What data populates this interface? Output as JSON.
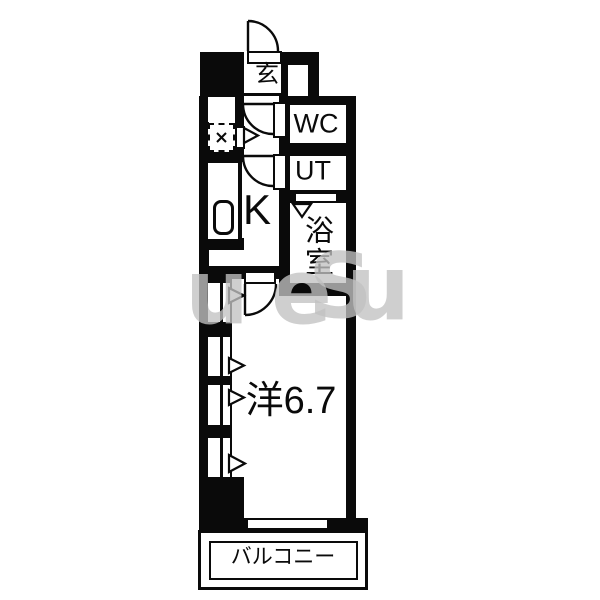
{
  "plan": {
    "type": "apartment-floor-plan",
    "rooms": {
      "genkan": {
        "label": "玄"
      },
      "wc": {
        "label": "WC"
      },
      "ut": {
        "label": "UT"
      },
      "bath": {
        "label": "浴室"
      },
      "kitchen": {
        "label": "K"
      },
      "western": {
        "label": "洋6.7",
        "size_tatami": "6.7"
      },
      "balcony": {
        "label": "バルコニー"
      }
    },
    "icons": [
      "entrance-door-arc",
      "wc-door-arc",
      "ut-door-arc",
      "room-door-arc",
      "bath-folding-door-marker",
      "pipe-space-x",
      "window-arrows"
    ]
  },
  "watermark": {
    "letters": [
      {
        "ch": "u"
      },
      {
        "ch": "e"
      },
      {
        "ch": "S"
      },
      {
        "ch": "u"
      }
    ],
    "color": "#c2c2c2"
  },
  "colors": {
    "wall": "#0a0a0a",
    "floor": "#ffffff"
  }
}
